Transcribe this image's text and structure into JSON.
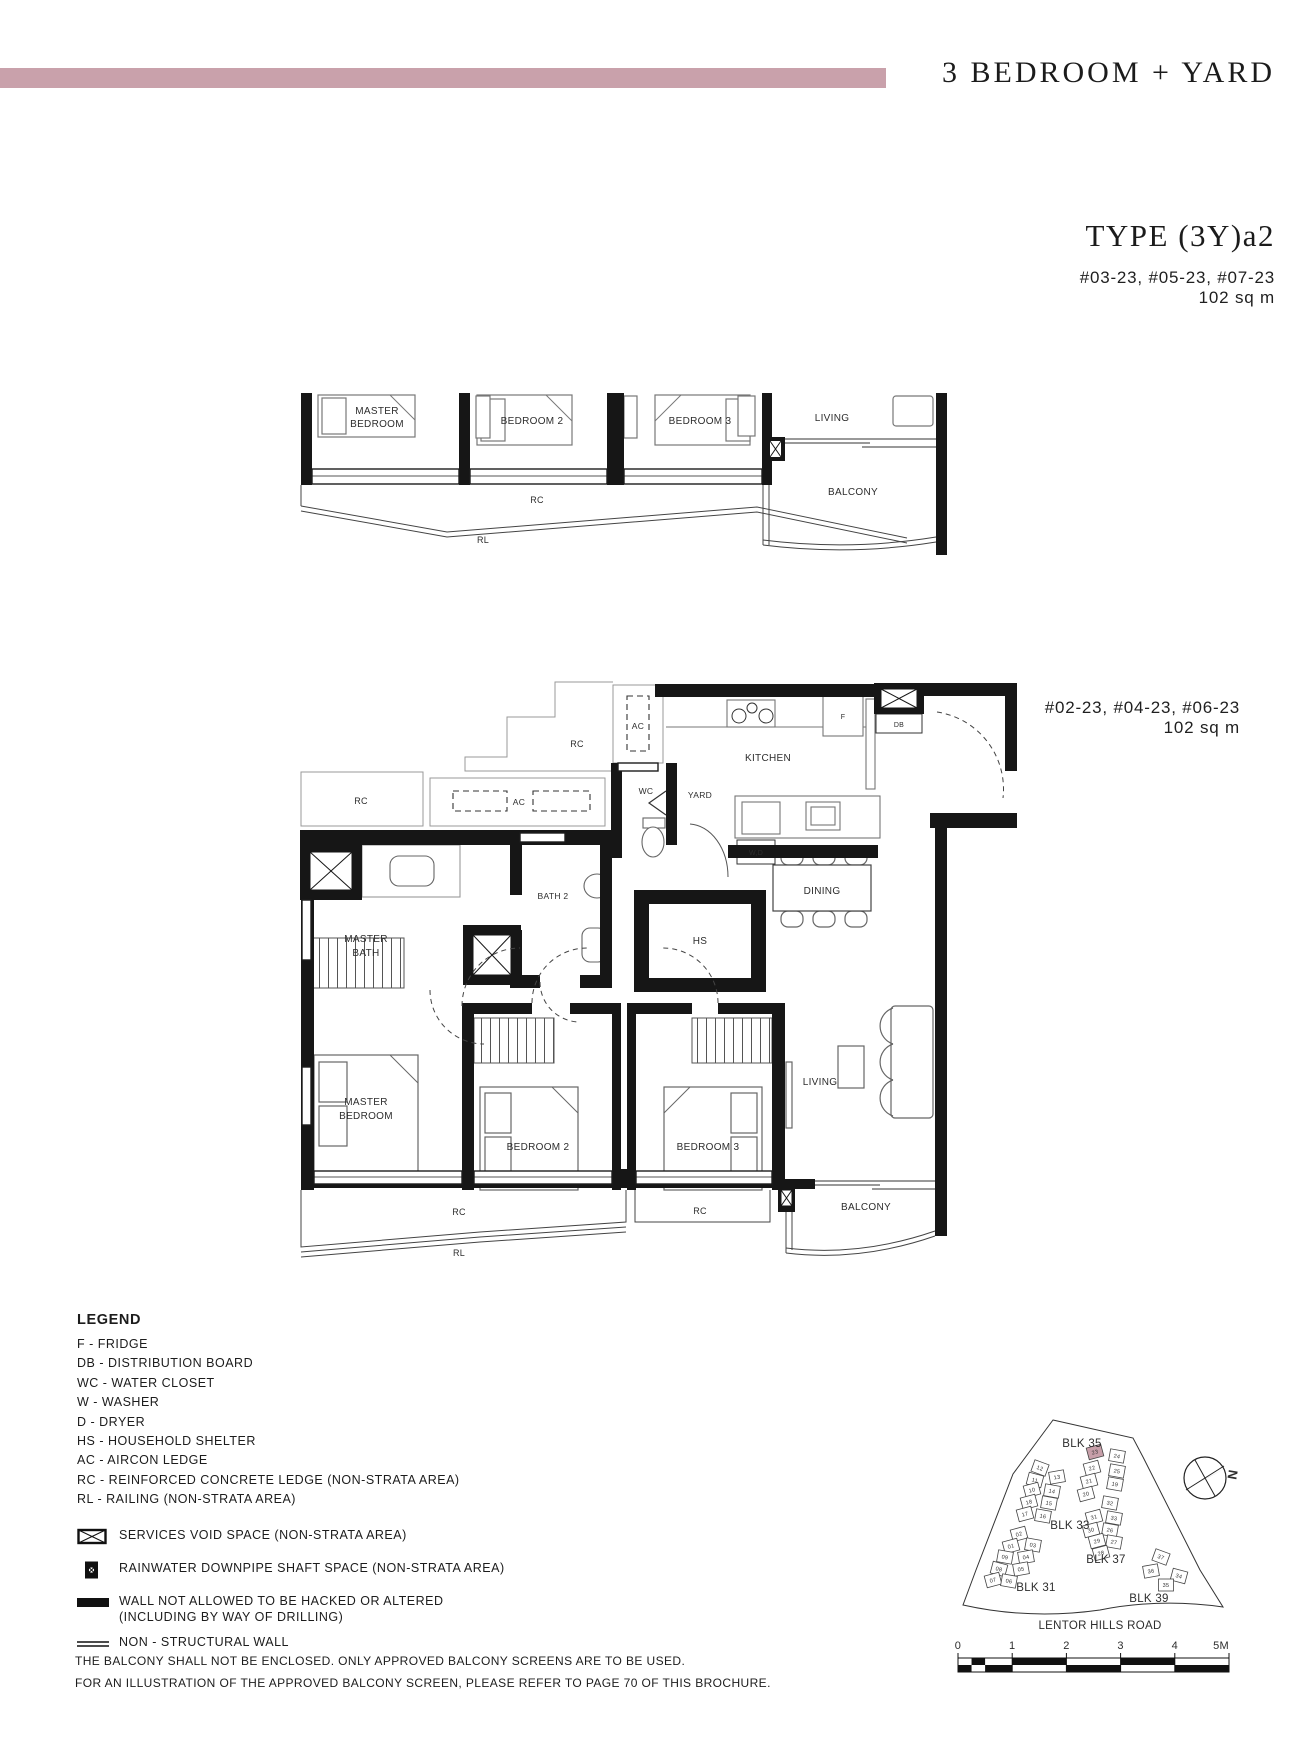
{
  "header": {
    "category": "3 BEDROOM + YARD",
    "type": "TYPE (3Y)a2",
    "stack_upper_units": "#03-23, #05-23, #07-23",
    "stack_upper_area": "102 sq m",
    "stack_lower_units": "#02-23, #04-23, #06-23",
    "stack_lower_area": "102 sq m"
  },
  "colors": {
    "accent": "#c9a1ab",
    "highlight": "#c79fa9",
    "line": "#1c1c1c"
  },
  "top_plan": {
    "master_bedroom_1": "MASTER",
    "master_bedroom_2": "BEDROOM",
    "bedroom2": "BEDROOM 2",
    "bedroom3": "BEDROOM 3",
    "living": "LIVING",
    "balcony": "BALCONY",
    "rc": "RC",
    "rl": "RL"
  },
  "main_plan": {
    "kitchen": "KITCHEN",
    "yard": "YARD",
    "wc": "WC",
    "db": "DB",
    "fridge": "F",
    "washer_dryer": "W,D",
    "ac_upper": "AC",
    "ac_ledge": "AC",
    "rc_step": "RC",
    "rc_box": "RC",
    "bath2": "BATH 2",
    "master_bath_1": "MASTER",
    "master_bath_2": "BATH",
    "hs": "HS",
    "dining": "DINING",
    "master_bedroom_1": "MASTER",
    "master_bedroom_2": "BEDROOM",
    "bedroom2": "BEDROOM 2",
    "bedroom3": "BEDROOM 3",
    "living": "LIVING",
    "balcony": "BALCONY",
    "rc_left": "RC",
    "rc_right": "RC",
    "rl": "RL"
  },
  "legend": {
    "title": "LEGEND",
    "items": [
      "F - FRIDGE",
      "DB - DISTRIBUTION BOARD",
      "WC - WATER CLOSET",
      "W - WASHER",
      "D - DRYER",
      "HS - HOUSEHOLD SHELTER",
      "AC - AIRCON LEDGE",
      "RC - REINFORCED CONCRETE LEDGE (NON-STRATA AREA)",
      "RL - RAILING (NON-STRATA AREA)"
    ],
    "symbols": [
      {
        "icon": "services-void-icon",
        "label": "SERVICES VOID SPACE (NON-STRATA AREA)"
      },
      {
        "icon": "rainwater-downpipe-icon",
        "label": "RAINWATER DOWNPIPE SHAFT SPACE (NON-STRATA AREA)"
      },
      {
        "icon": "hacked-wall-icon",
        "label": "WALL NOT ALLOWED TO BE HACKED OR ALTERED",
        "label2": "(INCLUDING BY WAY OF DRILLING)"
      },
      {
        "icon": "non-structural-wall-icon",
        "label": "NON - STRUCTURAL WALL"
      }
    ]
  },
  "site_plan": {
    "road": "LENTOR HILLS ROAD",
    "north_label": "N",
    "highlight_unit": "23",
    "highlight_color": "#c79fa9",
    "blocks": [
      {
        "label": "BLK 35",
        "x": 1082,
        "y": 1447
      },
      {
        "label": "BLK 33",
        "x": 1070,
        "y": 1529
      },
      {
        "label": "BLK 37",
        "x": 1106,
        "y": 1563
      },
      {
        "label": "BLK 31",
        "x": 1036,
        "y": 1591
      },
      {
        "label": "BLK 39",
        "x": 1149,
        "y": 1602
      }
    ],
    "units": [
      {
        "n": "23",
        "x": 1095,
        "y": 1452,
        "r": -15,
        "hl": true
      },
      {
        "n": "24",
        "x": 1117,
        "y": 1456,
        "r": 10
      },
      {
        "n": "22",
        "x": 1092,
        "y": 1468,
        "r": -15
      },
      {
        "n": "25",
        "x": 1117,
        "y": 1471,
        "r": 10
      },
      {
        "n": "21",
        "x": 1089,
        "y": 1481,
        "r": -15
      },
      {
        "n": "19",
        "x": 1115,
        "y": 1484,
        "r": 10
      },
      {
        "n": "20",
        "x": 1086,
        "y": 1494,
        "r": -15
      },
      {
        "n": "32",
        "x": 1110,
        "y": 1503,
        "r": 10
      },
      {
        "n": "31",
        "x": 1094,
        "y": 1517,
        "r": -15
      },
      {
        "n": "33",
        "x": 1114,
        "y": 1518,
        "r": 10
      },
      {
        "n": "30",
        "x": 1091,
        "y": 1530,
        "r": -15
      },
      {
        "n": "26",
        "x": 1110,
        "y": 1530,
        "r": 10
      },
      {
        "n": "29",
        "x": 1097,
        "y": 1541,
        "r": -15
      },
      {
        "n": "27",
        "x": 1114,
        "y": 1542,
        "r": 10
      },
      {
        "n": "28",
        "x": 1101,
        "y": 1553,
        "r": -15
      },
      {
        "n": "37",
        "x": 1161,
        "y": 1557,
        "r": 20
      },
      {
        "n": "36",
        "x": 1151,
        "y": 1571,
        "r": -10
      },
      {
        "n": "34",
        "x": 1179,
        "y": 1576,
        "r": 15
      },
      {
        "n": "35",
        "x": 1166,
        "y": 1585,
        "r": 0
      },
      {
        "n": "12",
        "x": 1040,
        "y": 1468,
        "r": 20
      },
      {
        "n": "13",
        "x": 1057,
        "y": 1477,
        "r": -10
      },
      {
        "n": "11",
        "x": 1035,
        "y": 1480,
        "r": 15
      },
      {
        "n": "10",
        "x": 1032,
        "y": 1490,
        "r": -15
      },
      {
        "n": "14",
        "x": 1052,
        "y": 1491,
        "r": 10
      },
      {
        "n": "18",
        "x": 1029,
        "y": 1502,
        "r": -15
      },
      {
        "n": "15",
        "x": 1049,
        "y": 1503,
        "r": 10
      },
      {
        "n": "17",
        "x": 1025,
        "y": 1514,
        "r": -15
      },
      {
        "n": "16",
        "x": 1043,
        "y": 1516,
        "r": 10
      },
      {
        "n": "02",
        "x": 1019,
        "y": 1534,
        "r": -15
      },
      {
        "n": "03",
        "x": 1033,
        "y": 1545,
        "r": 10
      },
      {
        "n": "01",
        "x": 1011,
        "y": 1546,
        "r": -15
      },
      {
        "n": "09",
        "x": 1005,
        "y": 1557,
        "r": 10
      },
      {
        "n": "04",
        "x": 1026,
        "y": 1557,
        "r": -10
      },
      {
        "n": "08",
        "x": 999,
        "y": 1569,
        "r": 15
      },
      {
        "n": "05",
        "x": 1021,
        "y": 1569,
        "r": -10
      },
      {
        "n": "07",
        "x": 993,
        "y": 1580,
        "r": -15
      },
      {
        "n": "06",
        "x": 1009,
        "y": 1581,
        "r": 10
      }
    ]
  },
  "scale_bar": {
    "ticks": [
      "0",
      "1",
      "2",
      "3",
      "4",
      "5M"
    ],
    "x": 958,
    "y": 1658,
    "width": 271,
    "row_height": 7
  },
  "footnotes": [
    "THE BALCONY SHALL NOT BE ENCLOSED. ONLY APPROVED BALCONY SCREENS ARE TO BE USED.",
    "FOR AN ILLUSTRATION OF THE APPROVED BALCONY SCREEN, PLEASE REFER TO PAGE 70 OF THIS BROCHURE."
  ]
}
